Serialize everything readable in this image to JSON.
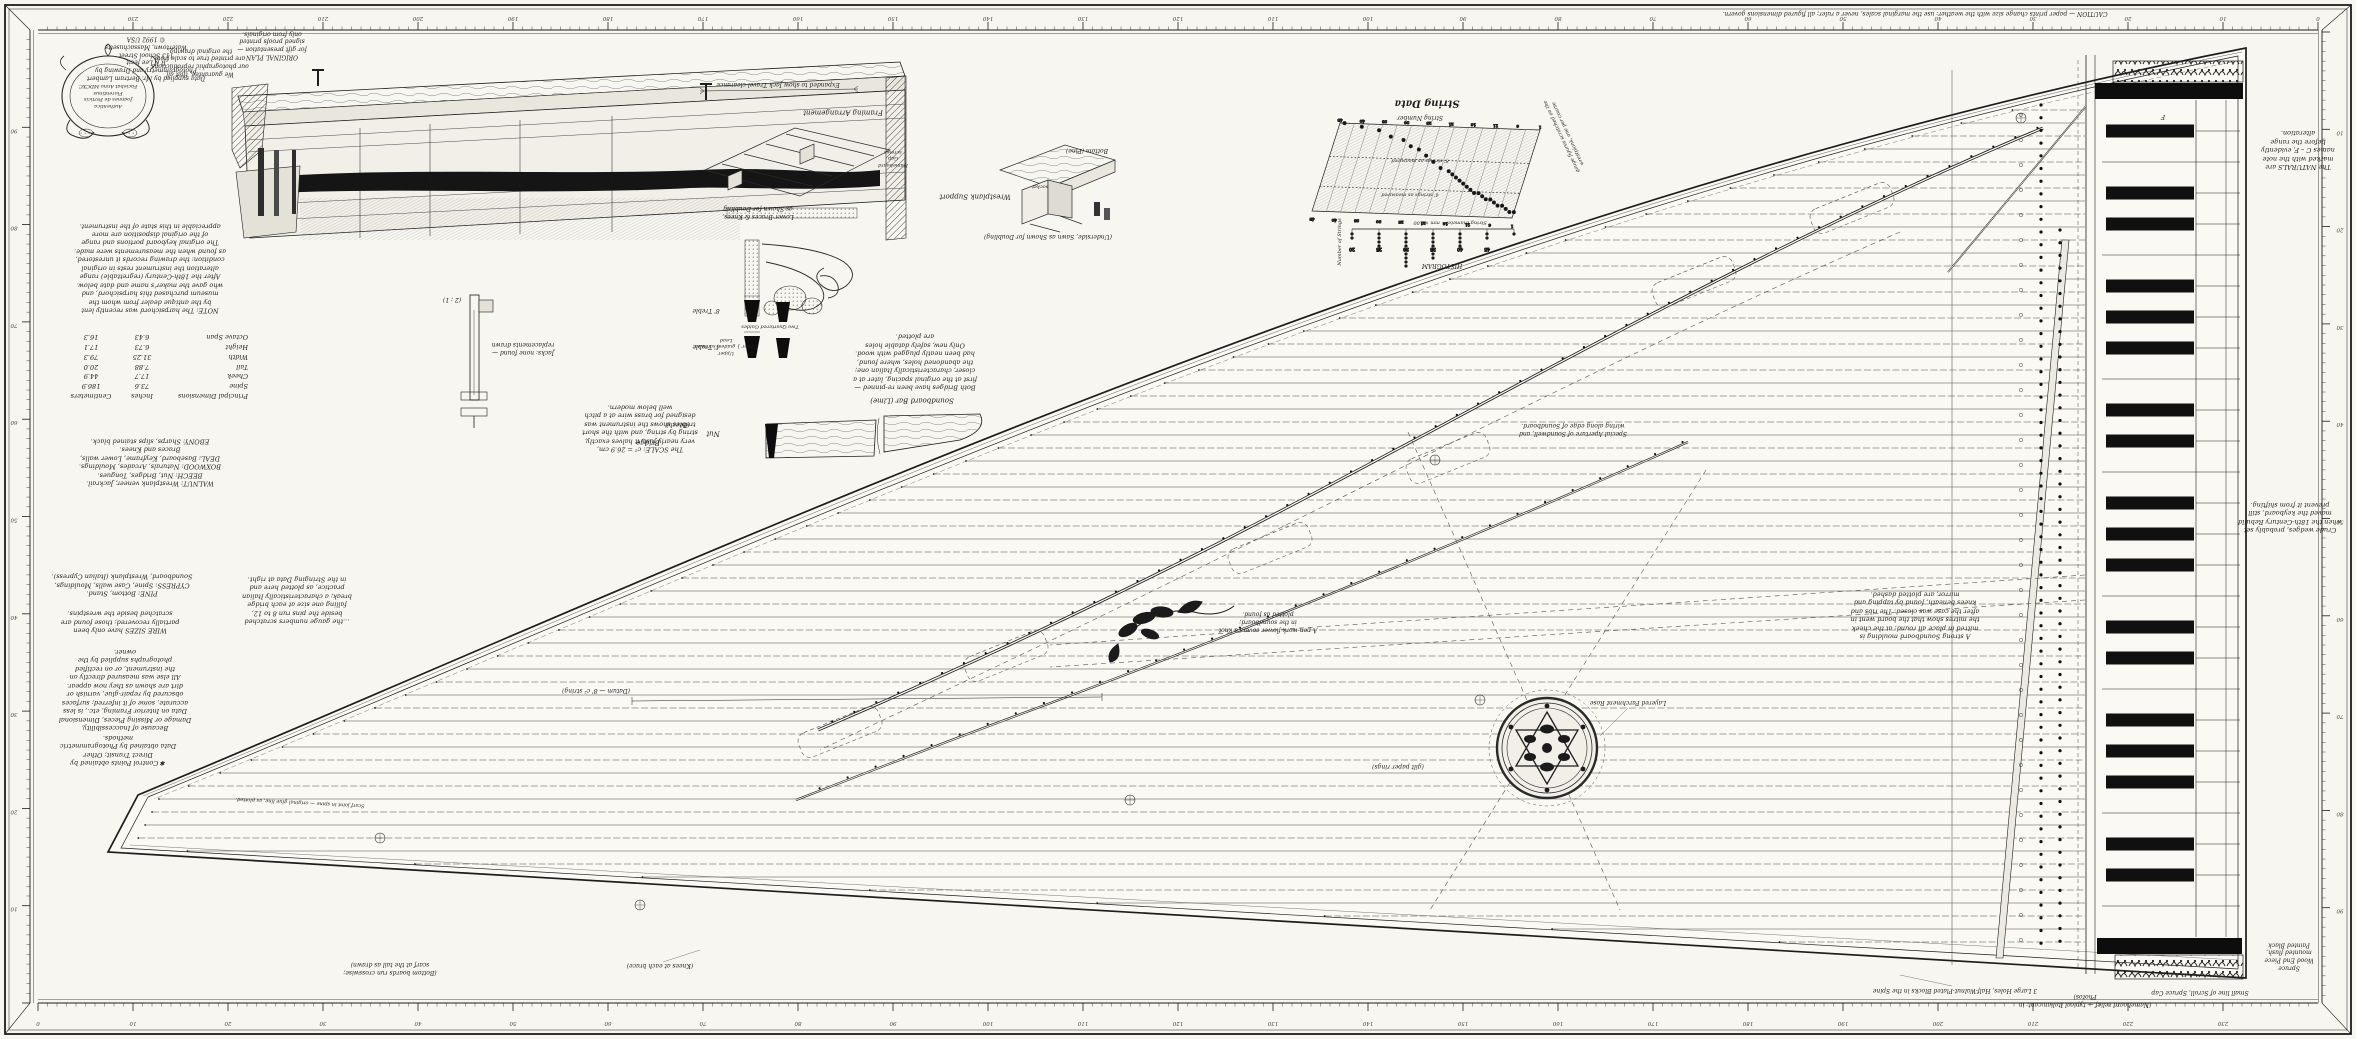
{
  "sheet": {
    "bg": "#f7f6f1",
    "ink": "#1d1d1d",
    "paper_inner": "#faf9f4"
  },
  "rulers": {
    "unit": "centimetres",
    "major_every": 10,
    "top_max": 240,
    "side_max": 100
  },
  "credit": {
    "text": "Data supplied by Mr. Bertram Lambert\nPhotogrammetry and Drawing by\nR K Lee   fecit\n113 School Street\nWatertown, Massachusetts\n© 1992 USA"
  },
  "cartouche": {
    "text": "Authentica\nJoannes de Perticis\nFlorentinus\nFaciebat Anno MDCXC"
  },
  "notes": {
    "caution": "CAUTION — paper prints change size with the weather: use the marginal scales, never a ruler; all figured dimensions govern.",
    "original_plan": "ORIGINAL PLAN\nfor gift presentation —\nsigned proofs printed\nonly from originals.",
    "guarantee": "We guarantee, that all\nour photographic reproductions\nare printed true to scale from\nthe original drawing.",
    "restoration": "NOTE: The harpsichord was recently lent\nby the antique dealer from whom the\nmuseum purchased this harpsichord, and\nwho gave the maker's name and date below.\nAfter the 18th-Century (regrettable) range\nalteration the instrument rests in original\ncondition: the drawing records it unrestored,\nas found when the measurements were made.\nThe original keyboard portions and range\nof the original disposition are more\nappreciable in this state of the instrument.",
    "col2": "…the gauge numbers scratched\nbeside the pins run 8 to 12,\nfalling one size at each bridge\nbreak; a characteristically Italian\npractice, as plotted here and\nin the Stringing Data at right.",
    "woods": "WALNUT: Wrestplank veneer, Jackrail.\nBEECH: Nut, Bridges, Tongues.\nBOXWOOD: Naturals, Arcades, Mouldings.\nDEAL: Baseboard, Keyframe, Lower walls,\nBraces and Knees.\nEBONY: Sharps, slips stained black.",
    "pine_cypress": "PINE: Bottom, Stand.\nCYPRESS: Spine, Case walls, Mouldings,\nSoundboard, Wrestplank (Italian Cypress).",
    "wire": "WIRE SIZES have only been\npartially recovered; those found are\nscratched beside the wrestpins.",
    "photo": "Because of Inaccessibility,\nDamage or Missing Pieces, Dimensional\nData on Interior Framing, etc., is less\naccurate, some of it inferred; surfaces\nobscured by repair-glue, varnish or\ndirt are shown as they now appear.\nAll else was measured directly on\nthe instrument, or on rectified\nphotographs supplied by the\nowner.",
    "control": "✱ Control Points obtained by\nDirect Transit;  Other\nData obtained by Photogrammetric\nmethods.",
    "scale": "The SCALE: c² = 26.9 cm,\nvery nearly just; it halves exactly,\nstring by string, and with the short\ntrebles shows the instrument was\ndesigned for brass wire at a pitch\nwell below modern.",
    "bridges": "Both Bridges have been re-pinned —\nfirst at the original spacing, later at a\ncloser, characteristically Italian one;\nthe abandoned holes, where found,\nhad been neatly plugged with wood.\nOnly new, safely datable holes\nare plotted.",
    "moulding": "A strong Soundboard moulding is\nmitred in place all round; at the cheek\nthe mitres show that the board went in\nafter the case was closed. The ribs and\nknees beneath, found by tapping and\nmirror, are plotted dashed.",
    "naturals": "The NATURALS are\nmarked with the note\nnames C – F, evidently\nbefore the range\nalteration.",
    "wedges": "Crude wedges, probably set\nwhen the 18th-Century Rebuild\nmoved the keyboard, still\nprevent it from shifting.",
    "aperture": "Special Aperture of Soundwell, and\nwiring along edge of Soundboard.",
    "rose": "Layered Parchment Rose",
    "rose_ring": "(gilt paper rings)",
    "flower": "A pen-work flower covers a knot\nin the soundboard;\nplotted as found.",
    "spine_joint": "Scarf joint in spine — original glue line, as plotted.",
    "tail_caption": "(Bottom boards run crosswise;\nscarf at the tail as drawn)"
  },
  "labels": {
    "framing": "Framing Arrangement",
    "framing_caption": "Lower Braces & Knees,\nas Shown for Doubling",
    "wp_support": "Wrestplank Support",
    "wp_bottom": "Bottom (Pine)",
    "wp_socket": "socket",
    "wp_caption": "(Underside, Sawn as Shown for Doubling)",
    "section_dim": "Expanded to show Jack Travel clearance",
    "gap_screws": "Nameboard\nGap\nscrews",
    "guides": "Two Quartered Guides",
    "bracket_stack": "Upper\nLower } guides, screwed\nLead",
    "sb_bar": "Soundboard Bar (Lime)",
    "nut": "Nut",
    "beech": "(Beech)",
    "bridge": "Bridge",
    "p8": "8' Treble",
    "p4": "4' Treble",
    "jack_caption": "Jacks: none found —\nreplacements drawn",
    "jack_scale": "(2 : 1)",
    "key_letter": "F",
    "datum": "(Datum — 8' c² string)",
    "b1": "3 Large Holes, Half-Walnut-Plated Blocks in the Spine",
    "b2": "(Nameboard relief — typical Italian cant; in Photos)",
    "b3": "Small line of Scroll, Spruce Cap",
    "b4": "Spruce\nWood End Piece\nmounted flush,\nPainted Black",
    "b5": "(Knees at each brace)"
  },
  "dimensions": {
    "title": "Principal Dimensions",
    "col_in": "Inches",
    "col_cm": "Centimeters",
    "rows": [
      {
        "name": "Spine",
        "in": "73.6",
        "cm": "186.9"
      },
      {
        "name": "Cheek",
        "in": "17.7",
        "cm": "44.9"
      },
      {
        "name": "Tail",
        "in": "7.88",
        "cm": "20.0"
      },
      {
        "name": "Width",
        "in": "31.25",
        "cm": "79.3"
      },
      {
        "name": "Height",
        "in": "6.73",
        "cm": "17.1"
      },
      {
        "name": "Octave Span",
        "in": "6.43",
        "cm": "16.3"
      }
    ]
  },
  "keyboard": {
    "naturals": 27,
    "top_note": "G",
    "sharp_color": "#101010"
  },
  "chart_data": {
    "type": "scatter",
    "title": "String Data",
    "xlabel": "String Number",
    "ylabel": "String Diameter – mm × 100",
    "x_range": [
      1,
      45
    ],
    "y_range": [
      20,
      50
    ],
    "side_note": "gauge figures scratched on the\nwrestplank, one per course",
    "overlay_labels": [
      "8' strings as measured",
      "4' strings as measured"
    ],
    "points": [
      [
        1,
        22
      ],
      [
        2,
        22
      ],
      [
        3,
        23
      ],
      [
        4,
        24
      ],
      [
        5,
        24
      ],
      [
        6,
        25
      ],
      [
        7,
        26
      ],
      [
        8,
        26
      ],
      [
        9,
        27
      ],
      [
        10,
        28
      ],
      [
        11,
        28
      ],
      [
        12,
        29
      ],
      [
        13,
        30
      ],
      [
        14,
        31
      ],
      [
        15,
        32
      ],
      [
        16,
        33
      ],
      [
        17,
        34
      ],
      [
        18,
        35
      ],
      [
        20,
        36
      ],
      [
        22,
        38
      ],
      [
        24,
        40
      ],
      [
        26,
        42
      ],
      [
        28,
        43
      ],
      [
        30,
        45
      ],
      [
        33,
        46
      ],
      [
        36,
        48
      ],
      [
        40,
        49
      ],
      [
        44,
        50
      ]
    ],
    "histogram": {
      "label": "HISTOGRAM",
      "xlabel": "String Diameter – mm × 100",
      "ylabel": "Number of Strings",
      "bins": [
        20,
        25,
        30,
        35,
        40,
        45,
        50
      ],
      "counts": [
        2,
        5,
        9,
        7,
        4,
        2,
        1
      ]
    }
  }
}
